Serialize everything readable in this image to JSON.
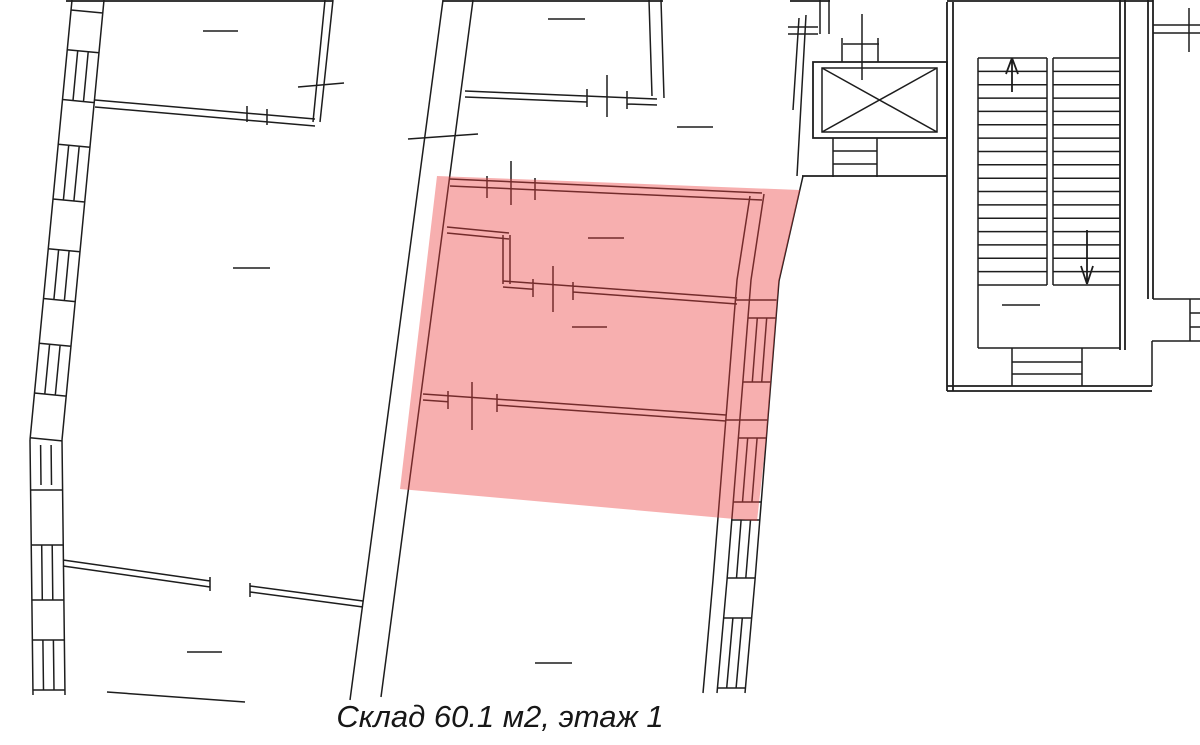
{
  "page": {
    "width": 1200,
    "height": 745,
    "background": "#ffffff"
  },
  "floor_plan": {
    "caption": "Склад 60.1 м2, этаж 1",
    "unit_label": "Склад",
    "unit_area": "60.1 м2",
    "unit_floor": "этаж 1",
    "line_color": "#1d1d1d",
    "highlight": {
      "fill": "rgba(235,64,64,0.42)"
    }
  }
}
